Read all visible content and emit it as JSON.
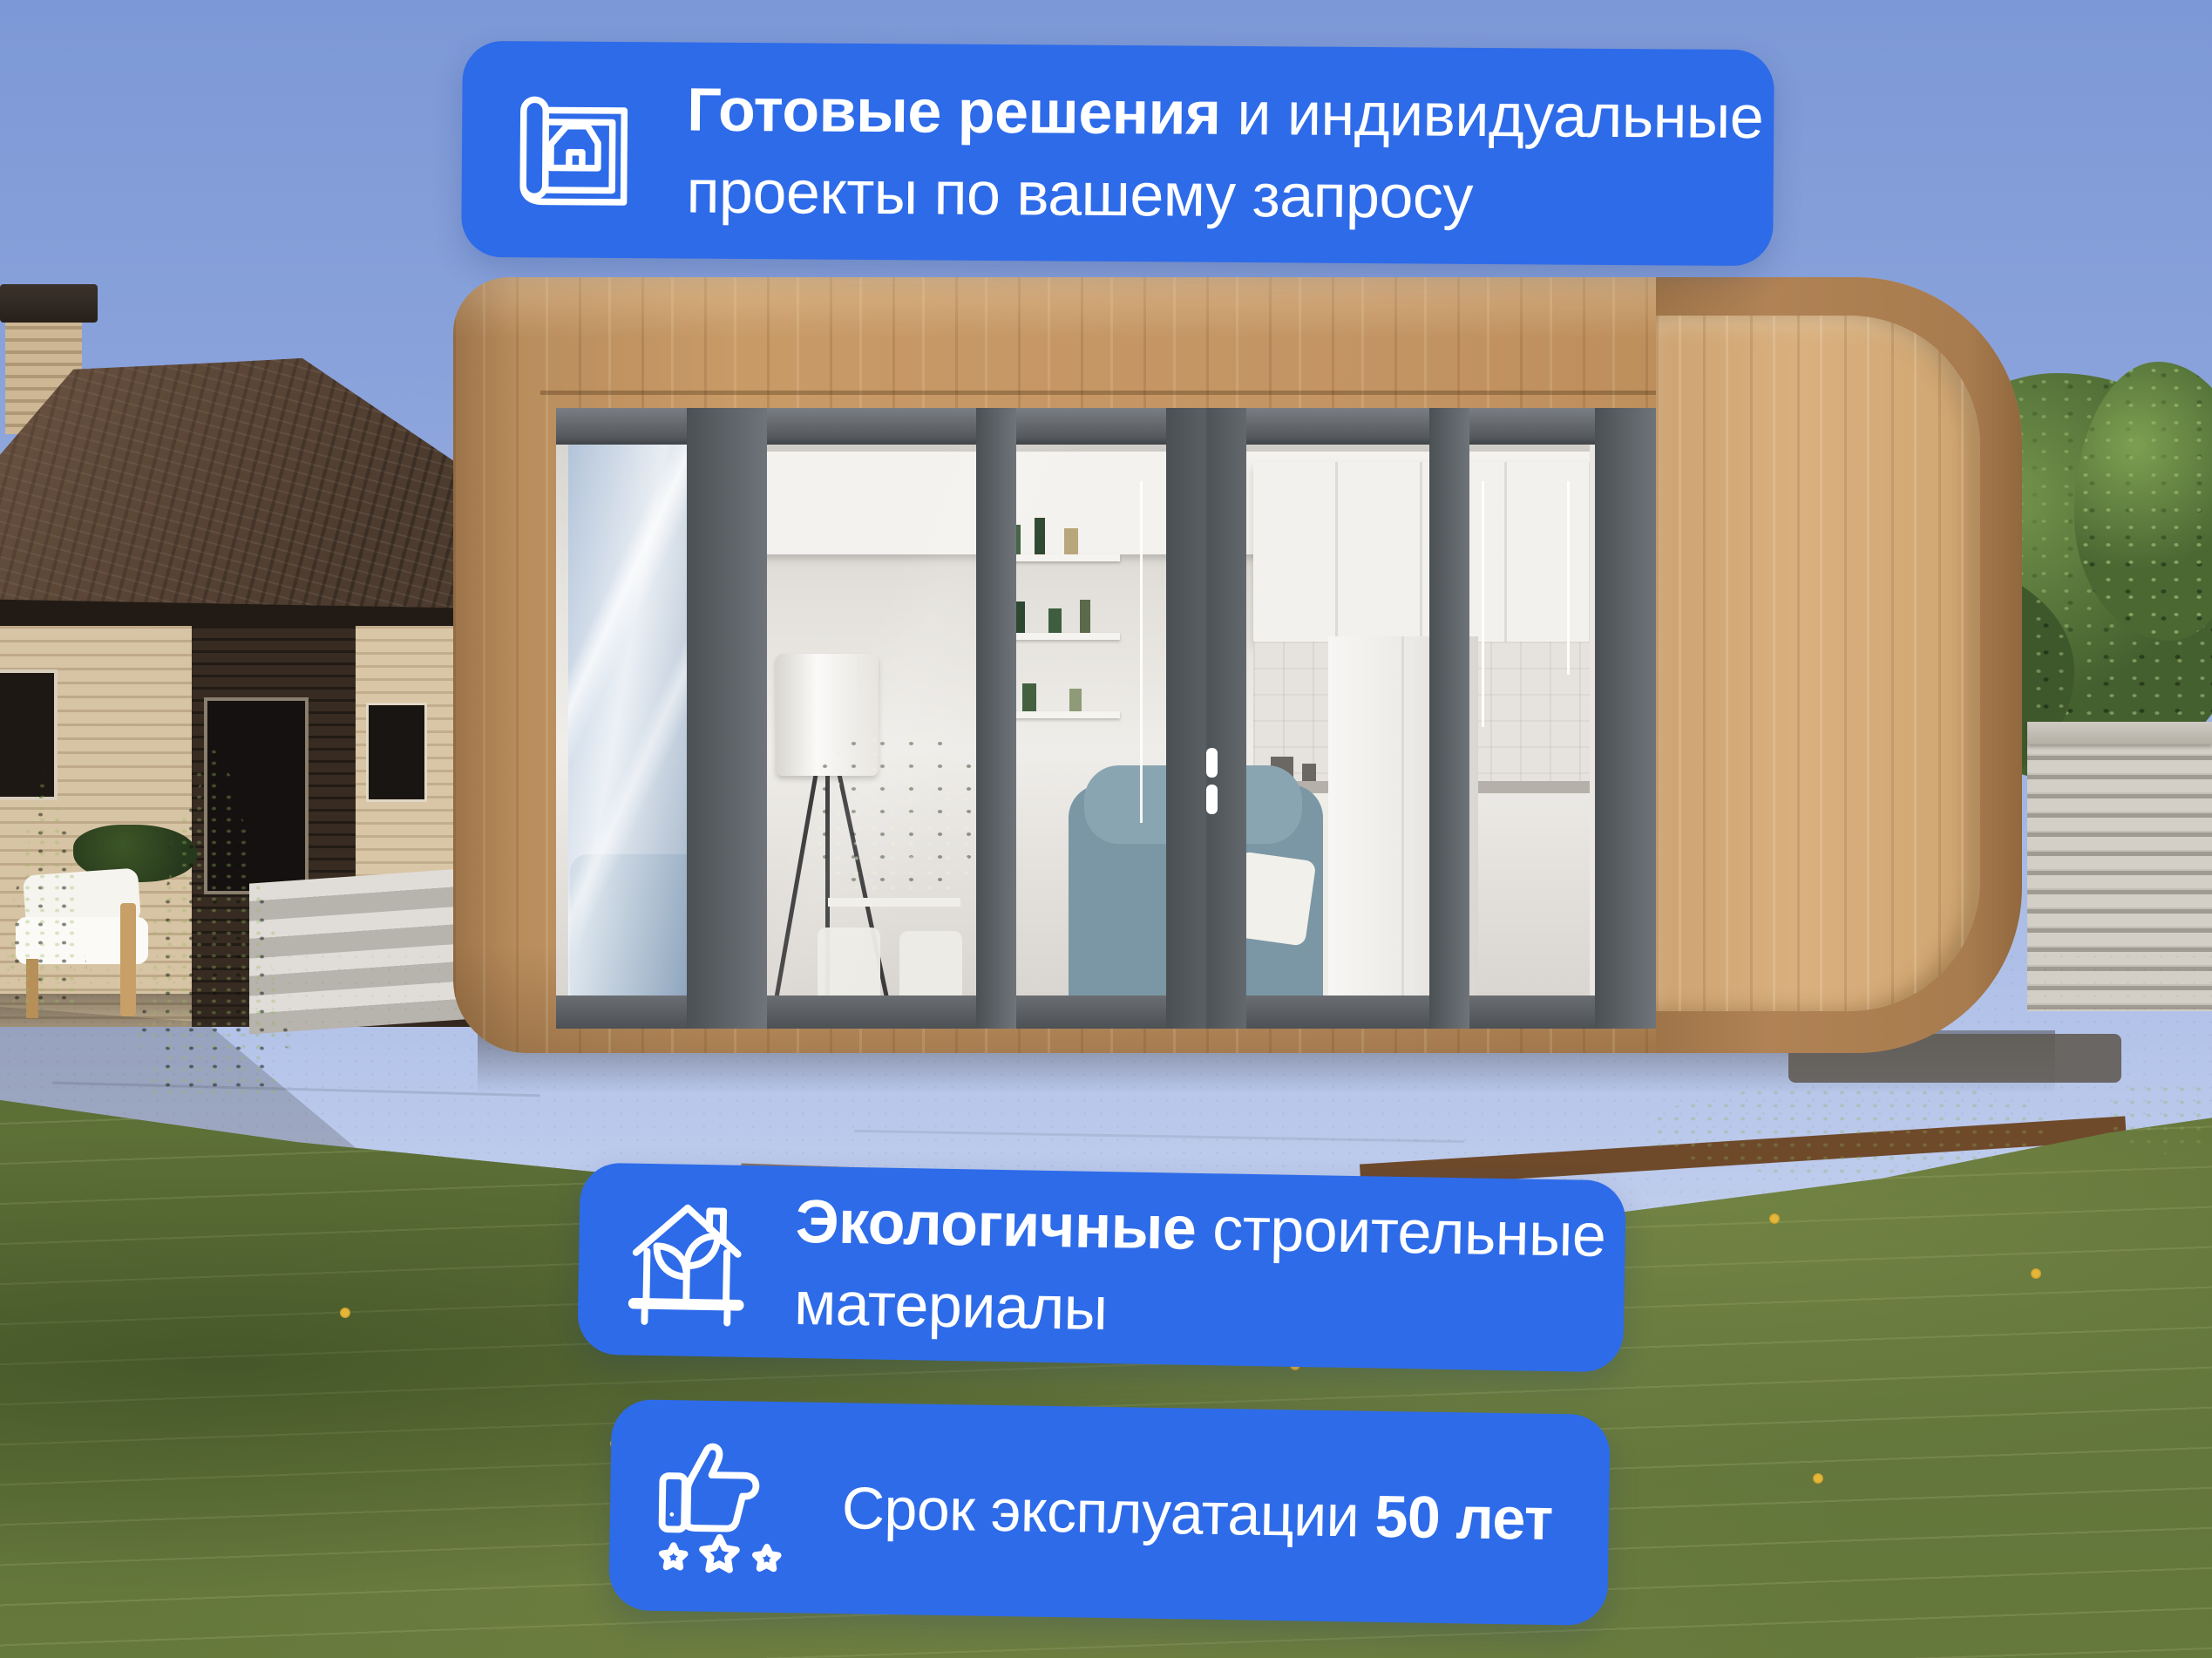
{
  "colors": {
    "badge_blue": "#2e6be9",
    "badge_text": "#ffffff"
  },
  "badges": {
    "top": {
      "icon": "blueprint-house-icon",
      "line1_bold": "Готовые решения",
      "line1_regular": " и индивидуальные",
      "line2": "проекты по вашему запросу"
    },
    "middle": {
      "icon": "eco-house-plant-icon",
      "line1_bold": "Экологичные",
      "line1_regular": " строительные",
      "line2": "материалы"
    },
    "bottom": {
      "icon": "thumbs-up-stars-icon",
      "line_regular": "Срок эксплуатации ",
      "line_bold": "50 лет"
    }
  }
}
